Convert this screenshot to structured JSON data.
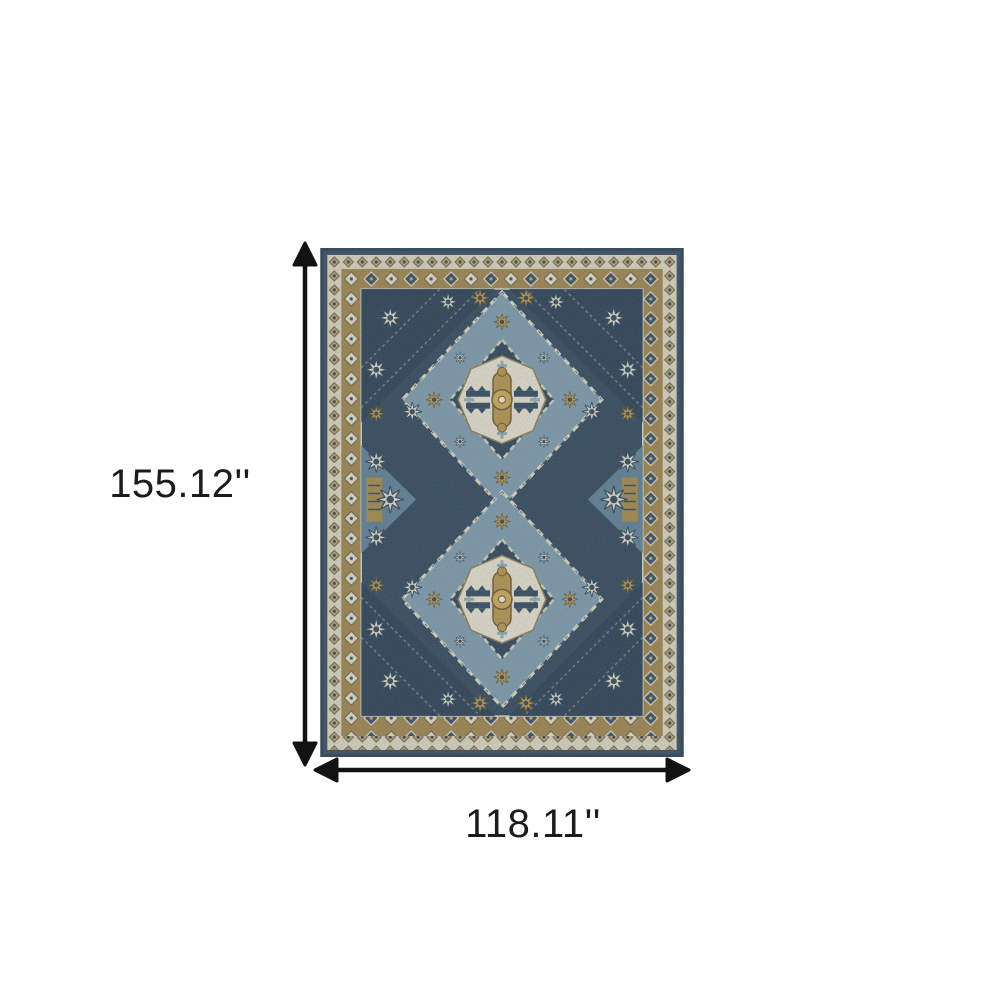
{
  "meta": {
    "subject": "blue and gold oriental area rug with two diamond medallions",
    "view": "top-down product dimension diagram"
  },
  "dimensions": {
    "height": {
      "label": "155.12''"
    },
    "width": {
      "label": "118.11''"
    }
  },
  "icons": {
    "vertical_arrow": "double-headed-vertical-arrow",
    "horizontal_arrow": "double-headed-horizontal-arrow"
  },
  "colors": {
    "background": "#ffffff",
    "arrow": "#121212",
    "label_text": "#1c1c1c",
    "rug_outer_navy": "#36495b",
    "rug_border_cream": "#d8d1bc",
    "rug_border_tan": "#9c8148",
    "rug_field_navy": "#2f4457",
    "rug_field_blue": "#57768b",
    "rug_medallion_light_blue": "#7b97a7",
    "rug_medallion_navy": "#2c4155",
    "rug_medallion_cream": "#e3dcc9",
    "rug_accent_gold": "#b3904a"
  }
}
